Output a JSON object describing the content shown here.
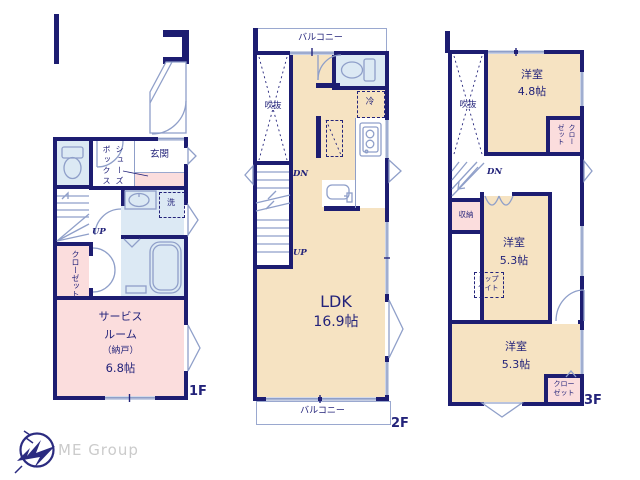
{
  "floor1": {
    "floor_label": "1F",
    "entrance_label": "玄関",
    "shoe_box_label": "シューズボックス",
    "laundry_label": "洗",
    "up_label": "UP",
    "closet_label": "クローゼット",
    "service_room_line1": "サービス",
    "service_room_line2": "ルーム",
    "service_room_line3": "（納戸）",
    "service_room_size": "6.8帖"
  },
  "floor2": {
    "floor_label": "2F",
    "balcony_top_label": "バルコニー",
    "balcony_bottom_label": "バルコニー",
    "void_label": "吹抜",
    "fridge_label": "冷",
    "down_label": "DN",
    "up_label": "UP",
    "ldk_label": "LDK",
    "ldk_size": "16.9帖"
  },
  "floor3": {
    "floor_label": "3F",
    "void_label": "吹抜",
    "bedroom1_label": "洋室",
    "bedroom1_size": "4.8帖",
    "closet1_label": "クローゼット",
    "down_label": "DN",
    "storage_label": "収納",
    "bedroom2_label": "洋室",
    "bedroom2_size": "5.3帖",
    "skylight_label": "トップライト",
    "bedroom3_label": "洋室",
    "bedroom3_size": "5.3帖",
    "closet2_label": "クローゼット"
  },
  "branding": {
    "logo_text": "ME Group"
  },
  "colors": {
    "wall": "#1d1d71",
    "room_cream": "#f6e3c2",
    "room_pink": "#fbdddd",
    "room_blue": "#dce9f4",
    "outline_light": "#8f9fc9",
    "text_navy": "#23237a",
    "logo_text": "#cbcbcb"
  }
}
